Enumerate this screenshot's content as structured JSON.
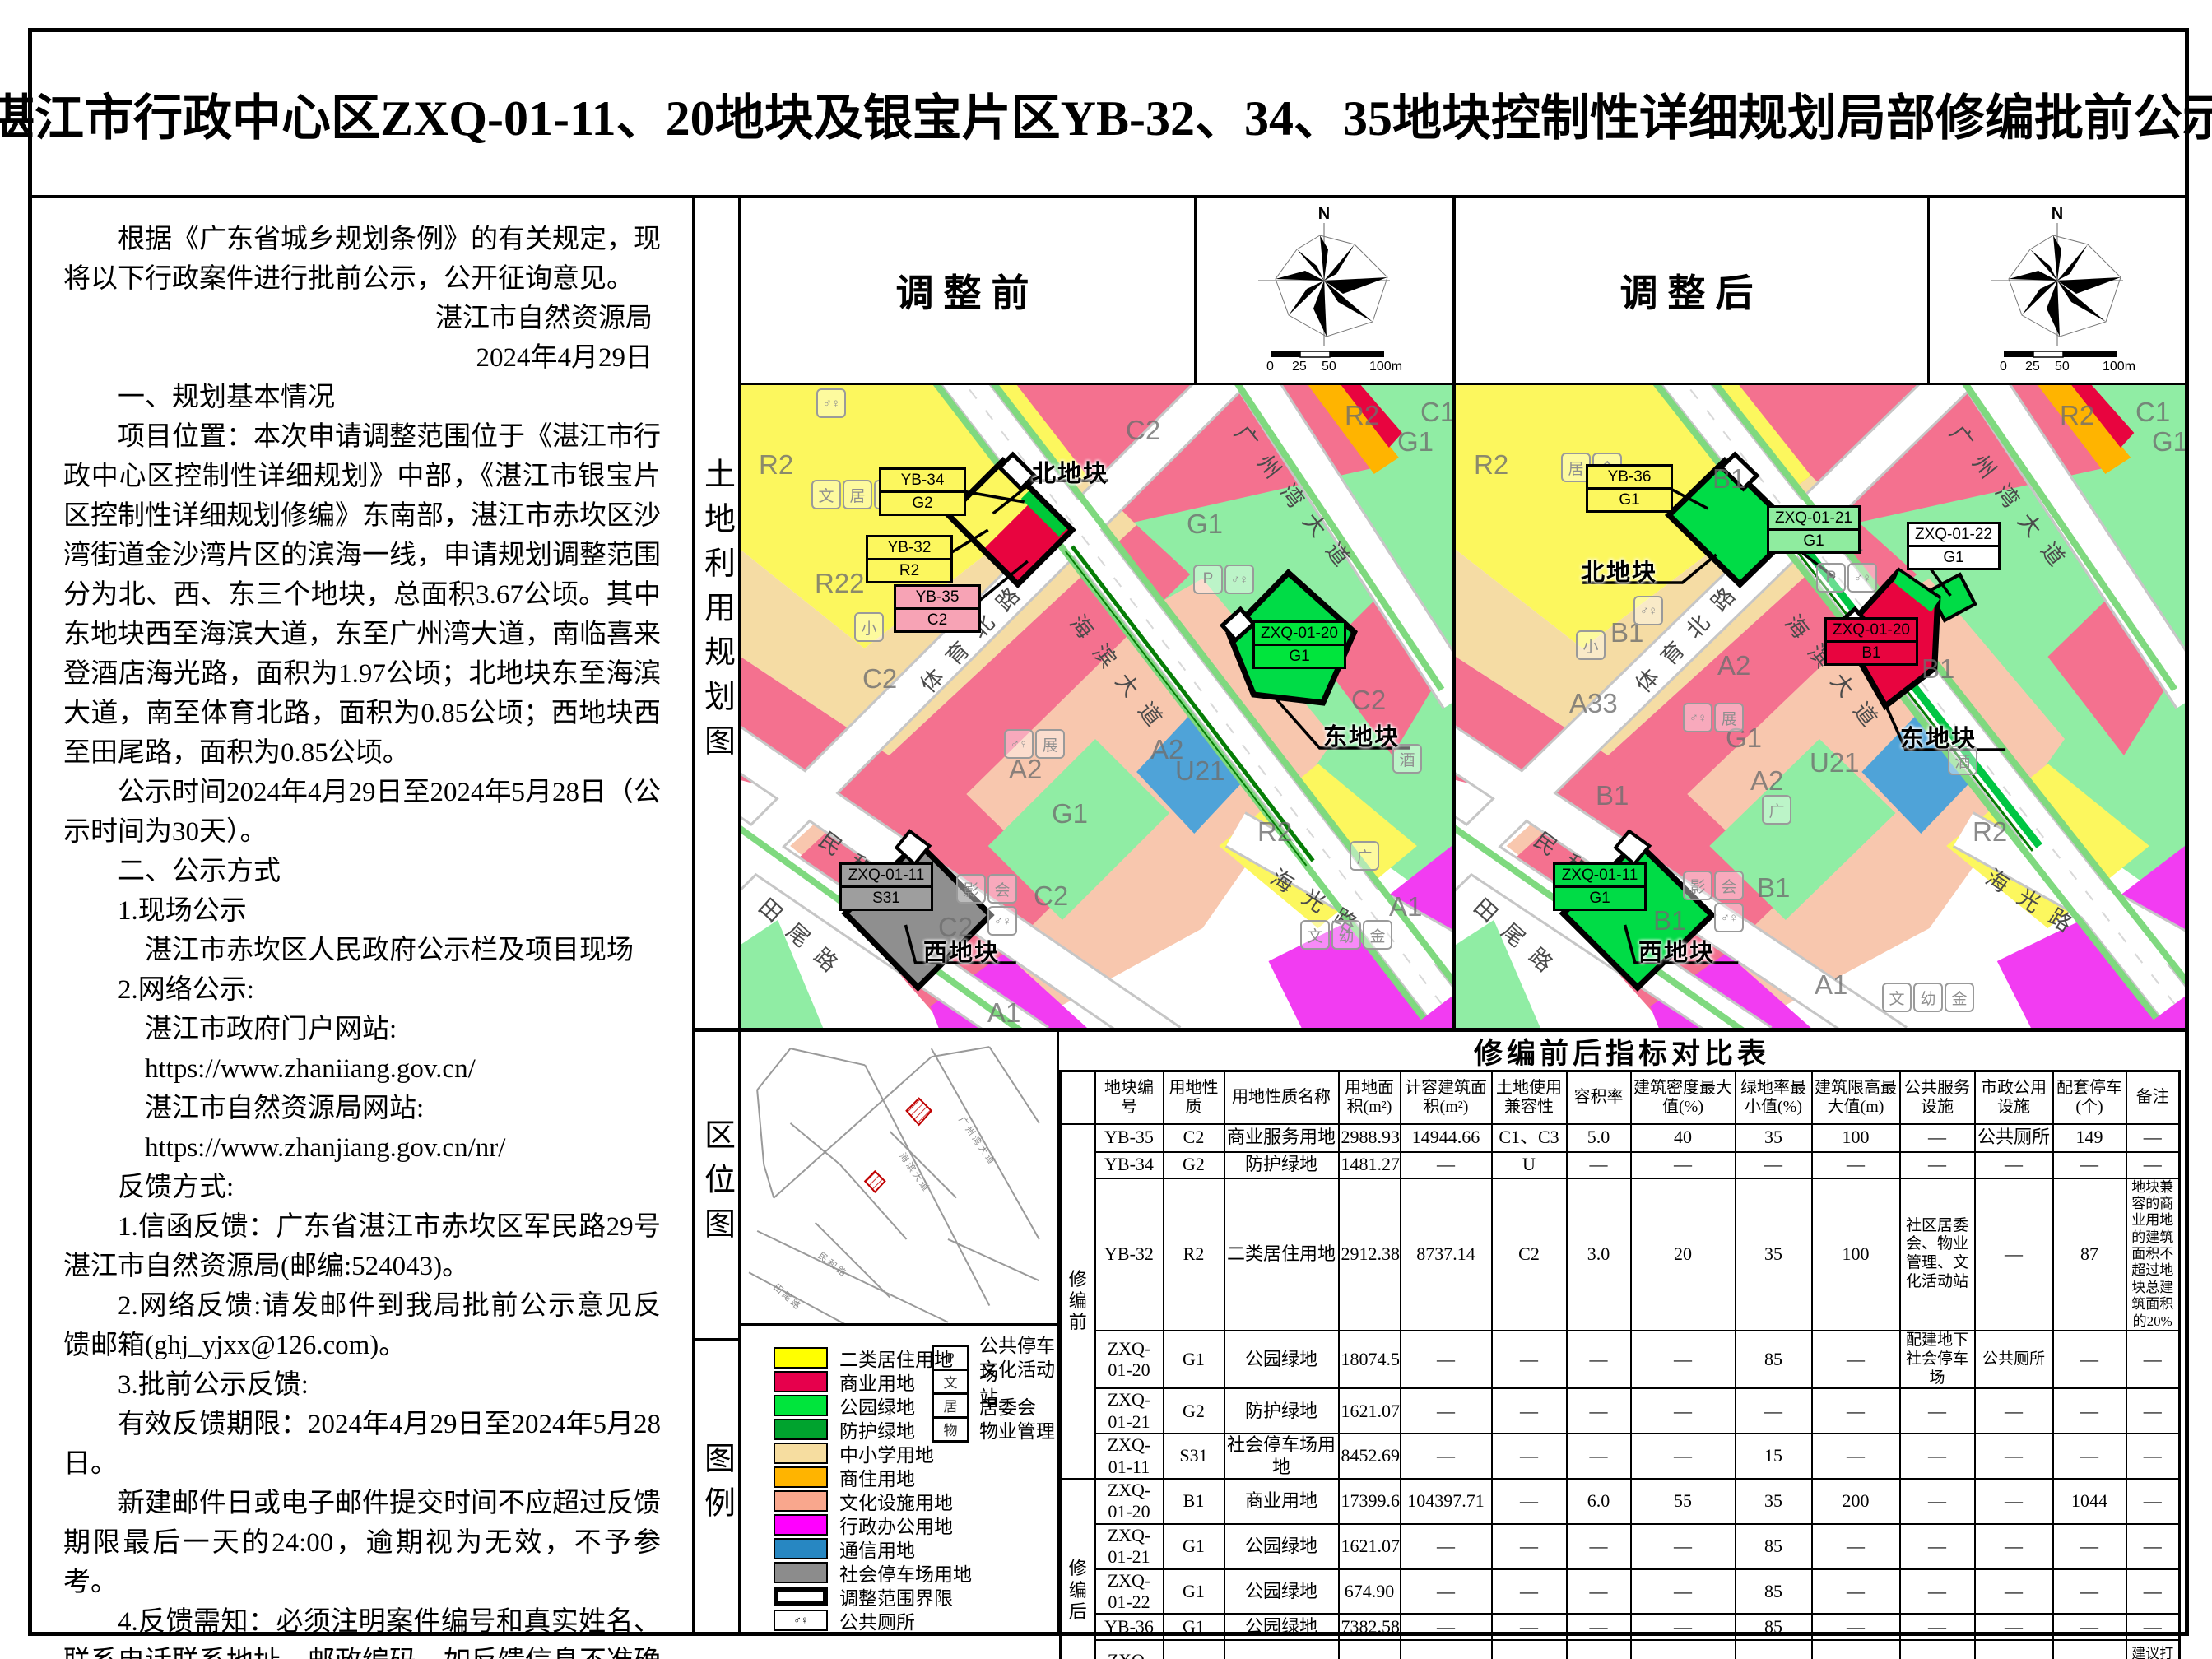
{
  "title": "湛江市行政中心区ZXQ-01-11、20地块及银宝片区YB-32、34、35地块控制性详细规划局部修编批前公示",
  "notice": {
    "paragraphs": [
      "根据《广东省城乡规划条例》的有关规定，现将以下行政案件进行批前公示，公开征询意见。",
      "湛江市自然资源局",
      "2024年4月29日",
      "一、规划基本情况",
      "项目位置：本次申请调整范围位于《湛江市行政中心区控制性详细规划》中部，《湛江市银宝片区控制性详细规划修编》东南部，湛江市赤坎区沙湾街道金沙湾片区的滨海一线，申请规划调整范围分为北、西、东三个地块，总面积3.67公顷。其中东地块西至海滨大道，东至广州湾大道，南临喜来登酒店海光路，面积为1.97公顷；北地块东至海滨大道，南至体育北路，面积为0.85公顷；西地块西至田尾路，面积为0.85公顷。",
      "公示时间2024年4月29日至2024年5月28日（公示时间为30天）。",
      "二、公示方式",
      "1.现场公示",
      "湛江市赤坎区人民政府公示栏及项目现场",
      "2.网络公示:",
      "湛江市政府门户网站:",
      "https://www.zhaniiang.gov.cn/",
      "湛江市自然资源局网站:",
      "https://www.zhanjiang.gov.cn/nr/",
      "反馈方式:",
      "1.信函反馈：广东省湛江市赤坎区军民路29号湛江市自然资源局(邮编:524043)。",
      "2.网络反馈:请发邮件到我局批前公示意见反馈邮箱(ghj_yjxx@126.com)。",
      "3.批前公示反馈:",
      "有效反馈期限：2024年4月29日至2024年5月28日。",
      "新建邮件日或电子邮件提交时间不应超过反馈期限最后一天的24:00，逾期视为无效，不予参考。",
      "4.反馈需知：必须注明案件编号和真实姓名、联系电话联系地址、邮政编码，如反馈信息不准确或不完整，导致无法核实有关情况的视为无效。"
    ]
  },
  "panels": {
    "land_use_label": "土地利用规划图",
    "location_label": "区位图",
    "legend_label": "图例"
  },
  "map_headers": {
    "before": "调整前",
    "after": "调整后",
    "north": "N",
    "scale": {
      "t0": "0",
      "t25": "25",
      "t50": "50",
      "t100": "100m"
    }
  },
  "map_before": {
    "road_labels": [
      "体育北路",
      "海滨大道",
      "广州湾大道",
      "民和路",
      "田尾路",
      "海光路"
    ],
    "zone_labels": [
      "R2",
      "R22",
      "C2",
      "C2",
      "A2",
      "A2",
      "G1",
      "G1",
      "G1",
      "U21",
      "R2",
      "C2",
      "A1",
      "C1",
      "R2",
      "C2",
      "C2",
      "A1"
    ],
    "icons": [
      "文",
      "居",
      "金",
      "♂♀",
      "小",
      "P",
      "♂♀",
      "♂♀",
      "展",
      "影",
      "会",
      "♂♀",
      "广",
      "酒",
      "文",
      "幼",
      "金"
    ],
    "blocks": {
      "b1": {
        "t": "YB-34",
        "b": "G2"
      },
      "b2": {
        "t": "YB-32",
        "b": "R2"
      },
      "b3": {
        "t": "YB-35",
        "b": "C2"
      },
      "b4": {
        "t": "ZXQ-01-20",
        "b": "G1"
      },
      "b5": {
        "t": "ZXQ-01-11",
        "b": "S31"
      },
      "north": "北地块",
      "east": "东地块",
      "west": "西地块"
    }
  },
  "map_after": {
    "road_labels": [
      "体育北路",
      "海滨大道",
      "广州湾大道",
      "民和路",
      "田尾路",
      "海光路"
    ],
    "zone_labels": [
      "R2",
      "A33",
      "B1",
      "B1",
      "A2",
      "A2",
      "G1",
      "G1",
      "G1",
      "U21",
      "R2",
      "B1",
      "A1",
      "C1",
      "R2",
      "B1",
      "B1",
      "B1"
    ],
    "icons": [
      "居",
      "金",
      "♂♀",
      "小",
      "P",
      "♂♀",
      "♂♀",
      "展",
      "影",
      "会",
      "♂♀",
      "广",
      "酒",
      "文",
      "幼",
      "金"
    ],
    "blocks": {
      "b1": {
        "t": "YB-36",
        "b": "G1"
      },
      "b2": {
        "t": "ZXQ-01-21",
        "b": "G1"
      },
      "b3": {
        "t": "ZXQ-01-22",
        "b": "G1"
      },
      "b4": {
        "t": "ZXQ-01-20",
        "b": "B1"
      },
      "b5": {
        "t": "ZXQ-01-11",
        "b": "G1"
      },
      "north": "北地块",
      "east": "东地块",
      "west": "西地块"
    }
  },
  "location_map": {
    "road_labels": [
      "海滨大道",
      "广州湾大道",
      "民和路",
      "田尾路"
    ]
  },
  "legend": {
    "left": [
      {
        "label": "二类居住用地"
      },
      {
        "label": "商业用地"
      },
      {
        "label": "公园绿地"
      },
      {
        "label": "防护绿地"
      },
      {
        "label": "中小学用地"
      },
      {
        "label": "商住用地"
      },
      {
        "label": "文化设施用地"
      },
      {
        "label": "行政办公用地"
      },
      {
        "label": "通信用地"
      },
      {
        "label": "社会停车场用地"
      },
      {
        "label": "调整范围界限"
      },
      {
        "label": "公共厕所",
        "char": "♂♀"
      }
    ],
    "right": [
      {
        "char": "P",
        "label": "公共停车场"
      },
      {
        "char": "文",
        "label": "文化活动站"
      },
      {
        "char": "居",
        "label": "居委会"
      },
      {
        "char": "物",
        "label": "物业管理"
      }
    ]
  },
  "table": {
    "title": "修编前后指标对比表",
    "groups": [
      "修编前",
      "修编后"
    ],
    "headers": [
      "地块编号",
      "用地性质",
      "用地性质名称",
      "用地面积(m²)",
      "计容建筑面积(m²)",
      "土地使用兼容性",
      "容积率",
      "建筑密度最大值(%)",
      "绿地率最小值(%)",
      "建筑限高最大值(m)",
      "公共服务设施",
      "市政公用设施",
      "配套停车(个)",
      "备注"
    ],
    "rows": [
      {
        "c": [
          "YB-35",
          "C2",
          "商业服务用地",
          "2988.93",
          "14944.66",
          "C1、C3",
          "5.0",
          "40",
          "35",
          "100",
          "—",
          "公共厕所",
          "149",
          "—"
        ]
      },
      {
        "c": [
          "YB-34",
          "G2",
          "防护绿地",
          "1481.27",
          "—",
          "U",
          "—",
          "—",
          "—",
          "—",
          "—",
          "—",
          "—",
          "—"
        ]
      },
      {
        "c": [
          "YB-32",
          "R2",
          "二类居住用地",
          "2912.38",
          "8737.14",
          "C2",
          "3.0",
          "20",
          "35",
          "100",
          "社区居委会、物业管理、文化活动站",
          "—",
          "87",
          "地块兼容的商业用地的建筑面积不超过地块总建筑面积的20%"
        ]
      },
      {
        "c": [
          "ZXQ-01-20",
          "G1",
          "公园绿地",
          "18074.52",
          "—",
          "—",
          "—",
          "—",
          "85",
          "—",
          "配建地下社会停车场",
          "公共厕所",
          "—",
          "—"
        ]
      },
      {
        "c": [
          "ZXQ-01-21",
          "G2",
          "防护绿地",
          "1621.07",
          "—",
          "—",
          "—",
          "—",
          "—",
          "—",
          "—",
          "—",
          "—",
          "—"
        ]
      },
      {
        "c": [
          "ZXQ-01-11",
          "S31",
          "社会停车场用地",
          "8452.69",
          "—",
          "—",
          "—",
          "—",
          "15",
          "—",
          "—",
          "—",
          "—",
          "—"
        ]
      },
      {
        "c": [
          "ZXQ-01-20",
          "B1",
          "商业用地",
          "17399.62",
          "104397.71",
          "—",
          "6.0",
          "55",
          "35",
          "200",
          "—",
          "—",
          "1044",
          "—"
        ]
      },
      {
        "c": [
          "ZXQ-01-21",
          "G1",
          "公园绿地",
          "1621.07",
          "—",
          "—",
          "—",
          "—",
          "85",
          "—",
          "—",
          "—",
          "—",
          "—"
        ]
      },
      {
        "c": [
          "ZXQ-01-22",
          "G1",
          "公园绿地",
          "674.90",
          "—",
          "—",
          "—",
          "—",
          "85",
          "—",
          "—",
          "—",
          "—",
          "—"
        ]
      },
      {
        "c": [
          "YB-36",
          "G1",
          "公园绿地",
          "7382.58",
          "—",
          "—",
          "—",
          "—",
          "85",
          "—",
          "—",
          "—",
          "—",
          "—"
        ]
      },
      {
        "c": [
          "ZXQ-01-11",
          "G1",
          "公园绿地",
          "8452.69",
          "—",
          "—",
          "—",
          "—",
          "85",
          "—",
          "—",
          "—",
          "—",
          "建议打造地下停车场"
        ]
      }
    ]
  },
  "colors": {
    "residential": "#FFFF00",
    "commercial": "#E6004C",
    "park_green": "#00E53C",
    "protective_green": "#00A32E",
    "school": "#F6DDA0",
    "mixed_commercial_residential": "#FFB400",
    "cultural": "#F9A78D",
    "admin_office": "#FF00FF",
    "telecom": "#2787C2",
    "social_parking": "#8C8C8C",
    "map_pink": "#F4718F",
    "map_red": "#E8043F",
    "map_light_green": "#90EDA4",
    "map_bright_green": "#00DC46",
    "map_salmon": "#F8C7AE",
    "map_wheat": "#F5DCA4",
    "map_magenta": "#F23CF2",
    "map_blue": "#4FA3D8",
    "map_gray": "#8F8F8F",
    "verge_green": "#7FD97F"
  }
}
